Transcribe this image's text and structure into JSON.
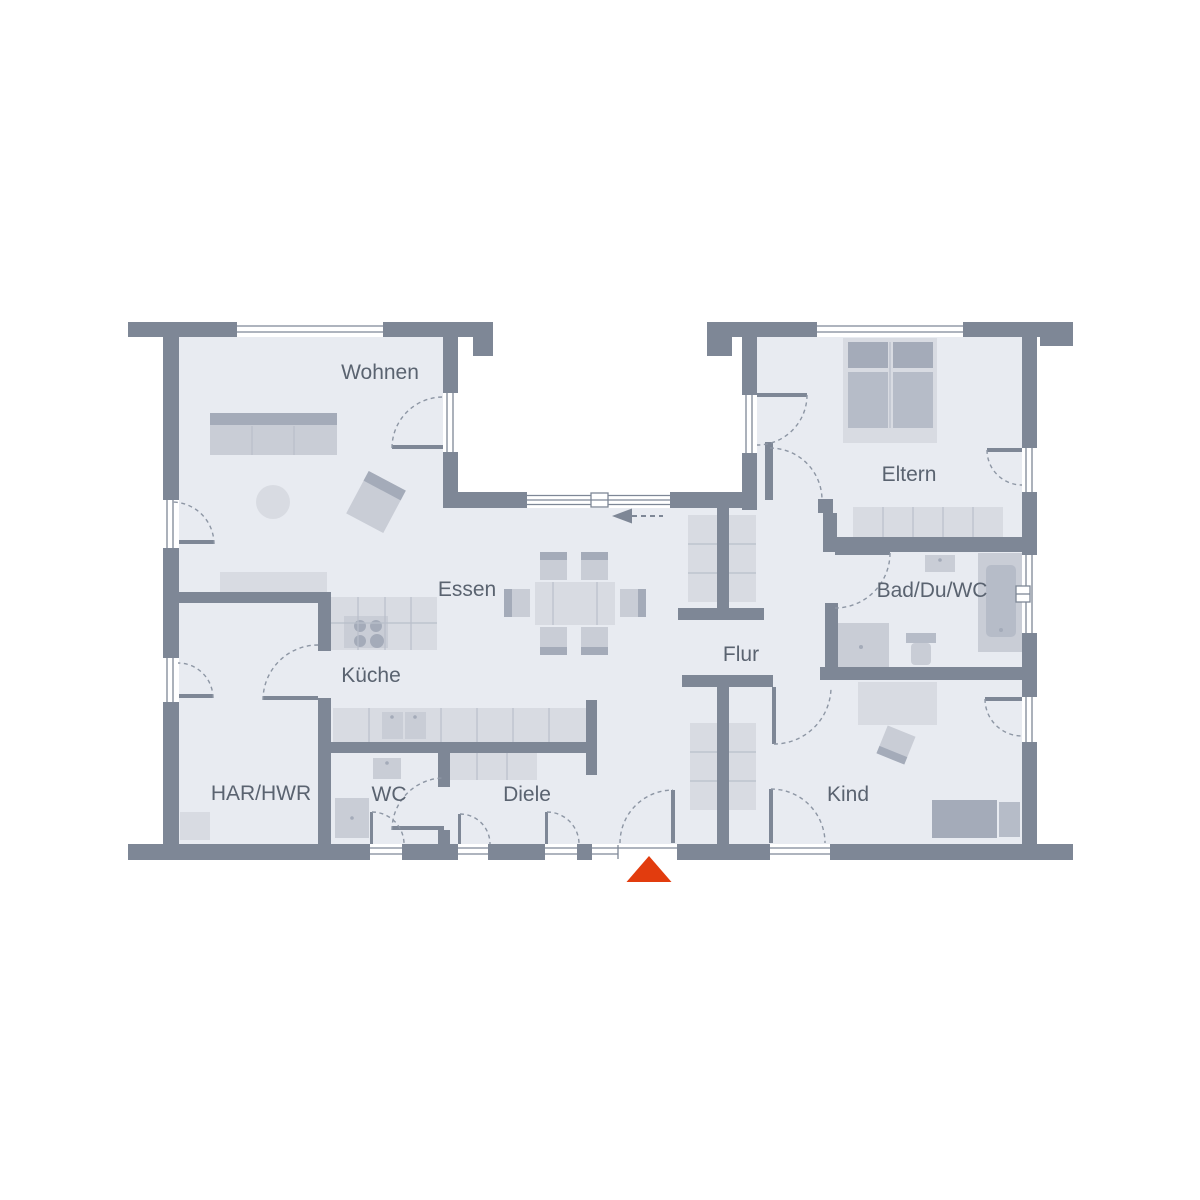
{
  "colors": {
    "wall": "#7e8796",
    "floor": "#e8ebf1",
    "window_bg": "#ffffff",
    "door_arc": "#8d96a4",
    "label": "#5a6370",
    "accent": "#e23c0e",
    "furniture_light": "#d8dbe2",
    "furniture_mid": "#c9cdd6",
    "furniture_shade": "#b6bcc8",
    "furniture_dark": "#a4abb9",
    "furniture_line": "#b9bfca"
  },
  "rooms": {
    "wohnen": "Wohnen",
    "essen": "Essen",
    "kueche": "Küche",
    "har_hwr": "HAR/HWR",
    "wc": "WC",
    "diele": "Diele",
    "flur": "Flur",
    "eltern": "Eltern",
    "bad": "Bad/Du/WC",
    "kind": "Kind"
  }
}
